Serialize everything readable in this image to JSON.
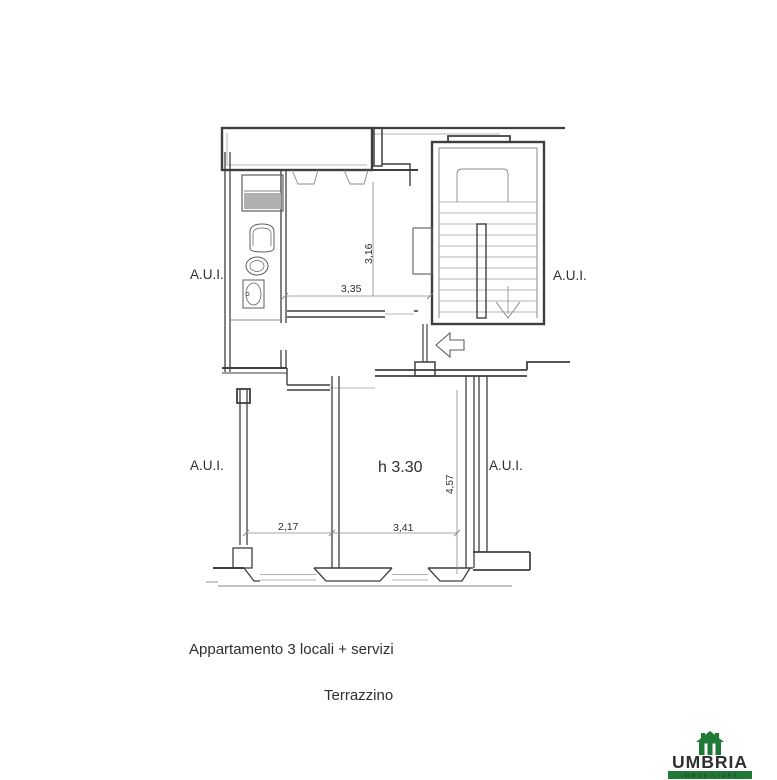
{
  "plan": {
    "labels": {
      "aui": "A.U.I.",
      "height": "h 3.30"
    },
    "dims": {
      "d316": "3,16",
      "d335": "3,35",
      "d457": "4,57",
      "d217": "2,17",
      "d341": "3,41"
    },
    "captions": {
      "apartment": "Appartamento 3 locali + servizi",
      "terrace": "Terrazzino"
    },
    "colors": {
      "wall_line": "#3f3f3f",
      "thin_line": "#8a8a8a",
      "text": "#2f2f2f",
      "cabinet_fill": "#b0b0b0"
    },
    "icons": {
      "entry": "arrow-left-icon",
      "stairs_direction": "arrow-down-icon"
    }
  },
  "logo": {
    "brand": "UMBRIA",
    "subtitle": "IMMOBILIARE",
    "brand_color": "#e30b1c",
    "green_color": "#1e7a34",
    "icon": "house-icon"
  }
}
